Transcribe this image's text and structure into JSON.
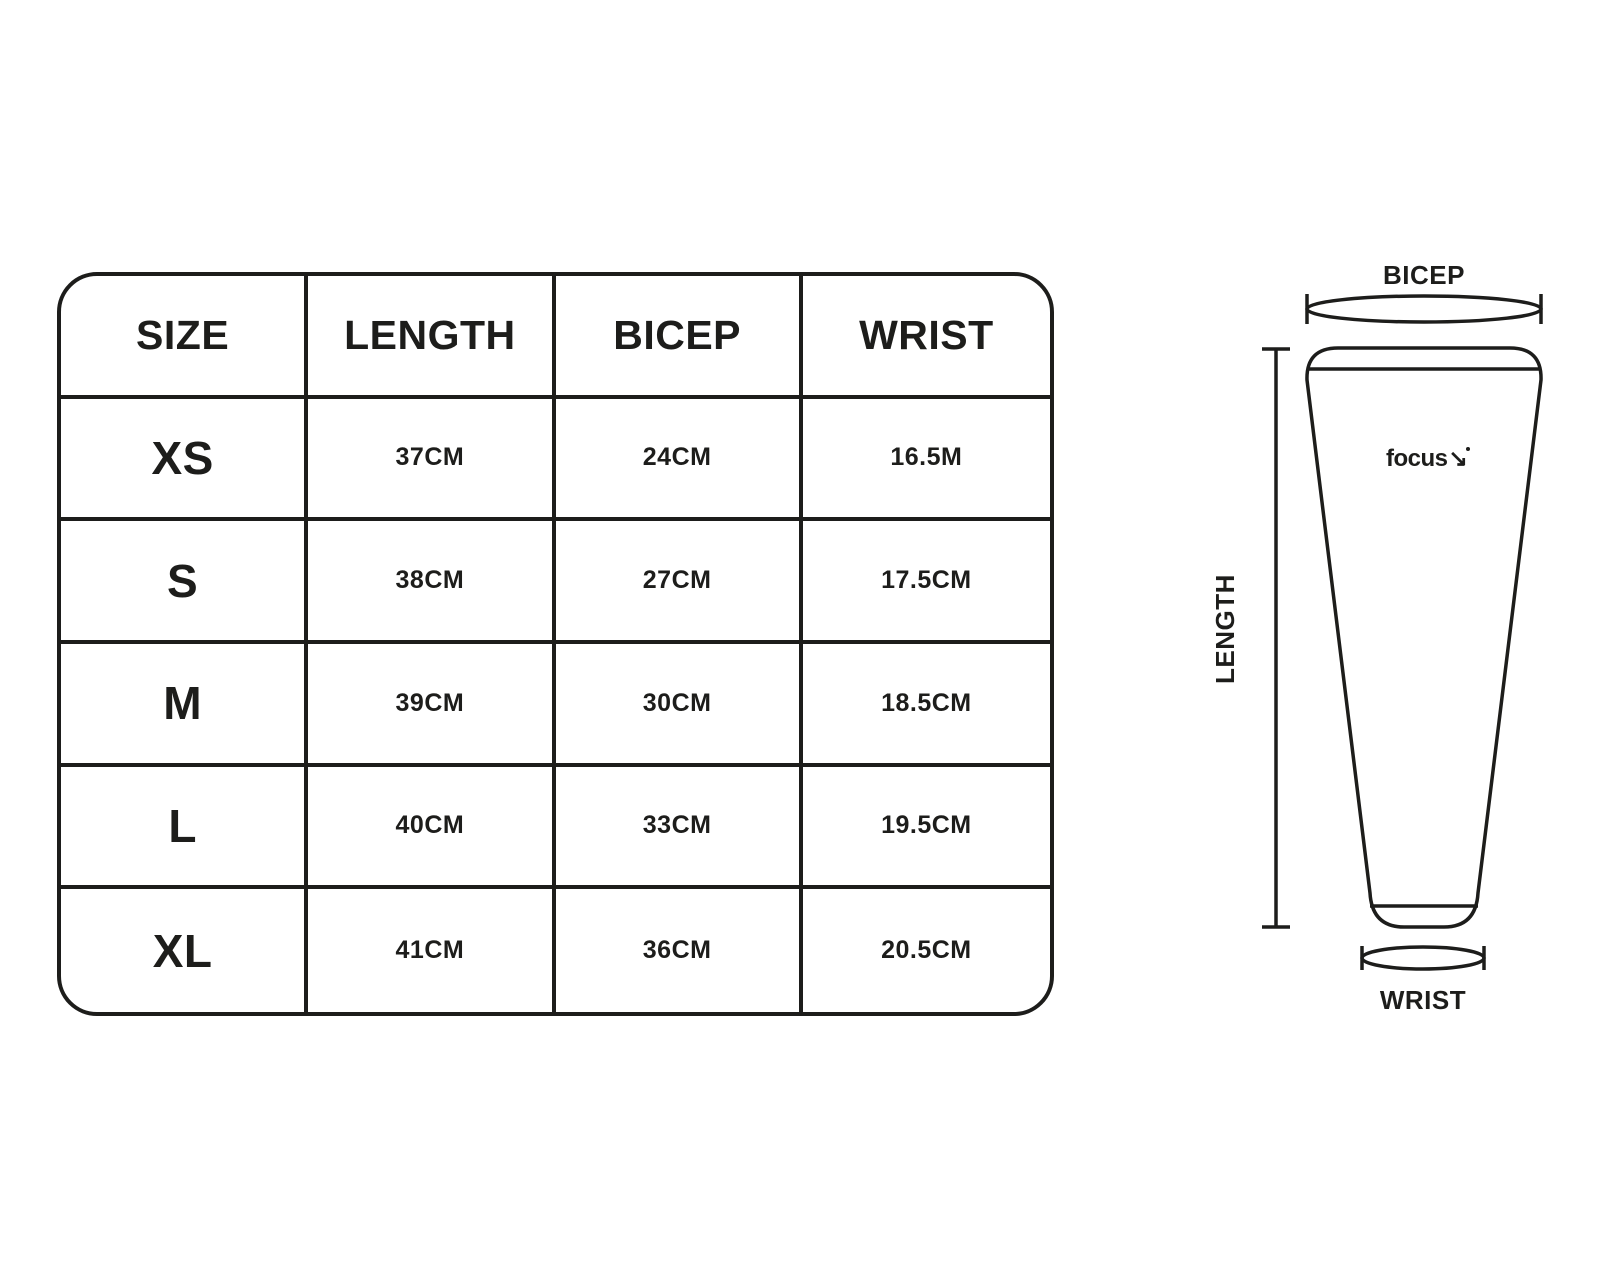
{
  "table": {
    "headers": [
      "SIZE",
      "LENGTH",
      "BICEP",
      "WRIST"
    ],
    "rows": [
      [
        "XS",
        "37CM",
        "24CM",
        "16.5M"
      ],
      [
        "S",
        "38CM",
        "27CM",
        "17.5CM"
      ],
      [
        "M",
        "39CM",
        "30CM",
        "18.5CM"
      ],
      [
        "L",
        "40CM",
        "33CM",
        "19.5CM"
      ],
      [
        "XL",
        "41CM",
        "36CM",
        "20.5CM"
      ]
    ]
  },
  "diagram": {
    "bicep_label": "BICEP",
    "length_label": "LENGTH",
    "wrist_label": "WRIST",
    "logo_text": "focus",
    "logo_mark": "↘"
  },
  "colors": {
    "ink": "#1d1d1b",
    "background": "#ffffff"
  }
}
